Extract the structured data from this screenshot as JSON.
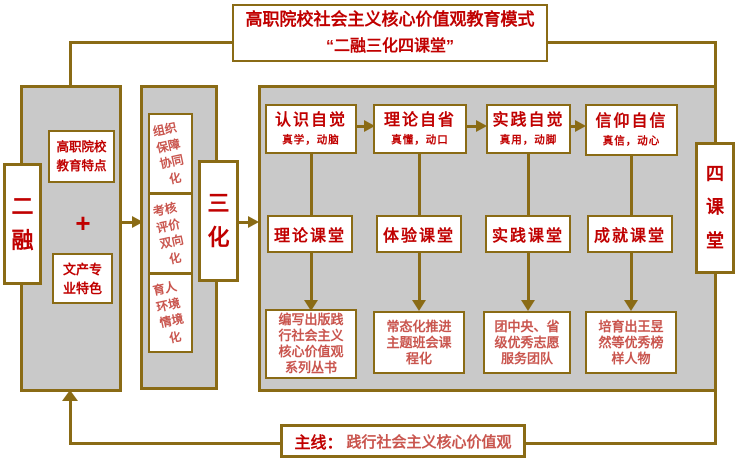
{
  "colors": {
    "gold": "#8a6b15",
    "red": "#c00000",
    "red_light": "#c9554e",
    "gray": "#c9c9c9"
  },
  "title": {
    "line1": "高职院校社会主义核心价值观教育模式",
    "line2": "“二融三化四课堂”"
  },
  "left_panel": {
    "label": "二\n融",
    "top_box": "高职院校\n教育特点",
    "plus": "+",
    "bottom_box": "文产专\n业特色"
  },
  "middle_panel": {
    "label": "三\n化",
    "boxes": [
      "组织\n保障\n协同\n化",
      "考核\n评价\n双向\n化",
      "育人\n环境\n情境\n化"
    ]
  },
  "right_panel": {
    "label": "四\n课\n堂",
    "columns": [
      {
        "awareness": "认识自觉",
        "sub": "真学，动脑",
        "classroom": "理论课堂",
        "outcome": "编写出版践\n行社会主义\n核心价值观\n系列丛书"
      },
      {
        "awareness": "理论自省",
        "sub": "真懂，动口",
        "classroom": "体验课堂",
        "outcome": "常态化推进\n主题班会课\n程化"
      },
      {
        "awareness": "实践自觉",
        "sub": "真用，动脚",
        "classroom": "实践课堂",
        "outcome": "团中央、省\n级优秀志愿\n服务团队"
      },
      {
        "awareness": "信仰自信",
        "sub": "真信，动心",
        "classroom": "成就课堂",
        "outcome": "培育出王昱\n然等优秀榜\n样人物"
      }
    ]
  },
  "mainline": {
    "label": "主线：",
    "text": "践行社会主义核心价值观"
  }
}
